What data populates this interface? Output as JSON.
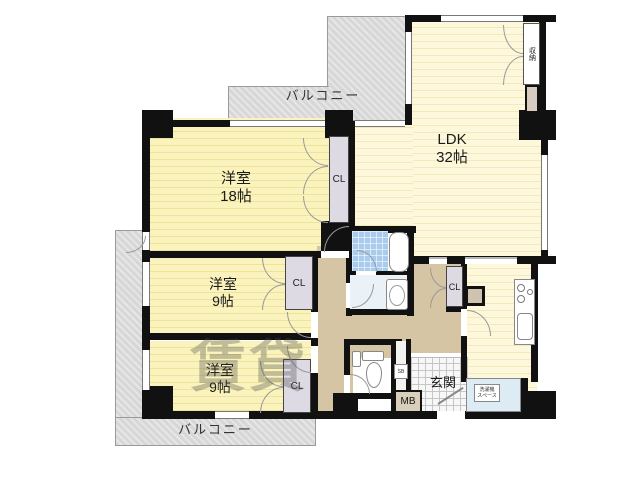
{
  "plan": {
    "rooms": {
      "ldk_name": "LDK",
      "ldk_size": "32帖",
      "room18_name": "洋室",
      "room18_size": "18帖",
      "room9m_name": "洋室",
      "room9m_size": "9帖",
      "room9b_name": "洋室",
      "room9b_size": "9帖",
      "balcony_top": "バルコニー",
      "balcony_bottom": "バルコニー",
      "entrance": "玄関",
      "storage": "収納"
    },
    "closets": [
      "CL",
      "CL",
      "CL",
      "CL"
    ],
    "boxes": {
      "meter_box": "MB",
      "shoe_box": "SB",
      "laundry_line1": "洗濯機",
      "laundry_line2": "スペース"
    },
    "watermark": "賃貸",
    "colors": {
      "wall": "#111111",
      "room_yellow": "#FBF3BE",
      "room_stripe": "#EFE29B",
      "ldk_yellow": "#FDF8DC",
      "ldk_stripe": "#F3E9BD",
      "hallway": "#D5C5A4",
      "balcony": "#DCDCDC",
      "bath_tile": "#A9CBEE",
      "closet": "#DDDAE3",
      "laundry": "#DDEBF5",
      "meter_box": "#D9CEBA"
    }
  }
}
